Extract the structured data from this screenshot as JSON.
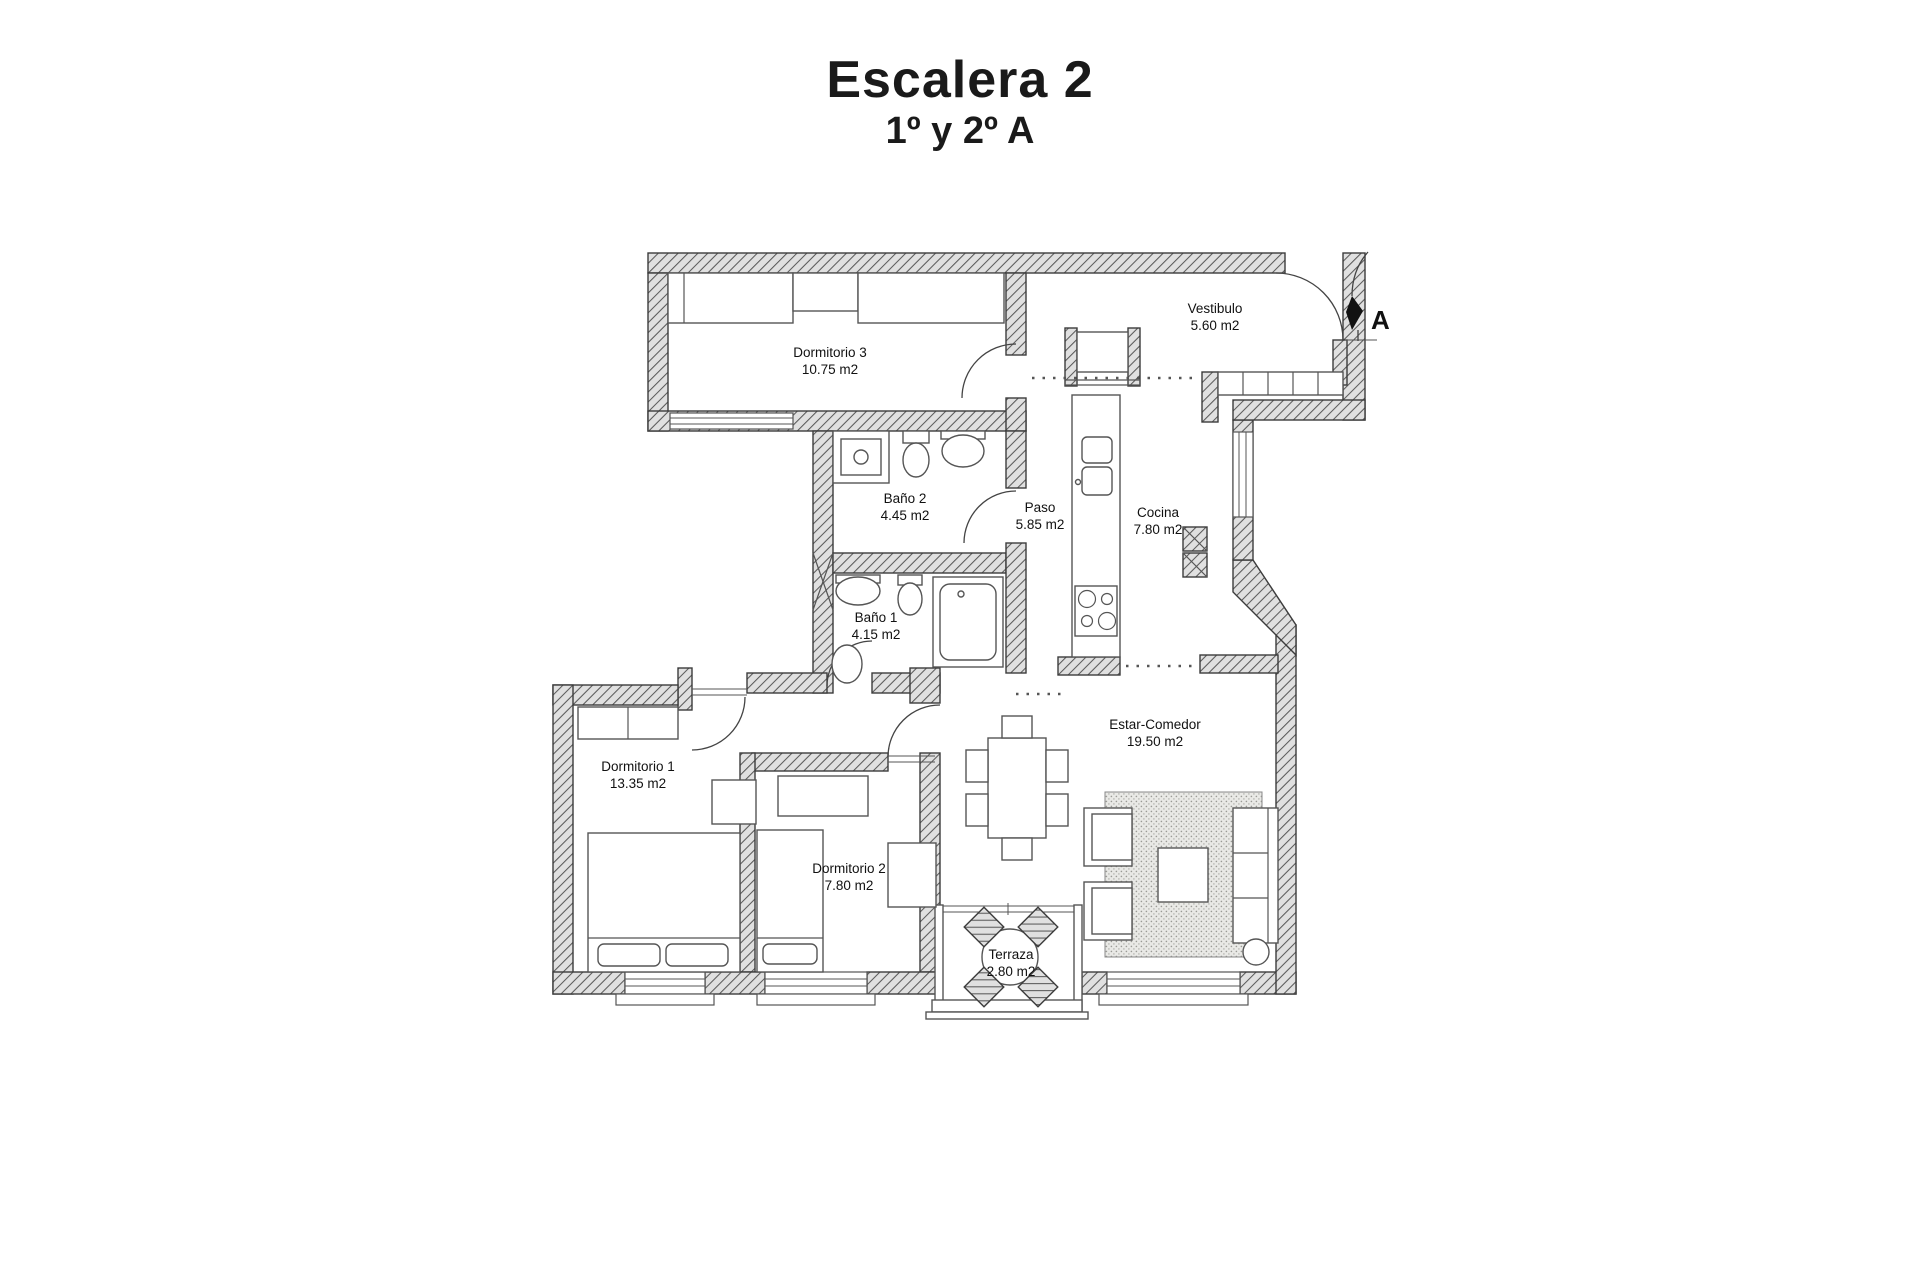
{
  "page": {
    "title": "Escalera 2",
    "subtitle": "1º y 2º A"
  },
  "entrance": {
    "label": "A"
  },
  "rooms": {
    "dormitorio3": {
      "name": "Dormitorio 3",
      "area": "10.75 m2"
    },
    "vestibulo": {
      "name": "Vestibulo",
      "area": "5.60 m2"
    },
    "bano2": {
      "name": "Baño 2",
      "area": "4.45 m2"
    },
    "paso": {
      "name": "Paso",
      "area": "5.85 m2"
    },
    "cocina": {
      "name": "Cocina",
      "area": "7.80 m2"
    },
    "bano1": {
      "name": "Baño 1",
      "area": "4.15 m2"
    },
    "dormitorio1": {
      "name": "Dormitorio 1",
      "area": "13.35 m2"
    },
    "dormitorio2": {
      "name": "Dormitorio 2",
      "area": "7.80 m2"
    },
    "estar_comedor": {
      "name": "Estar-Comedor",
      "area": "19.50 m2"
    },
    "terraza": {
      "name": "Terraza",
      "area": "2.80 m2"
    }
  }
}
